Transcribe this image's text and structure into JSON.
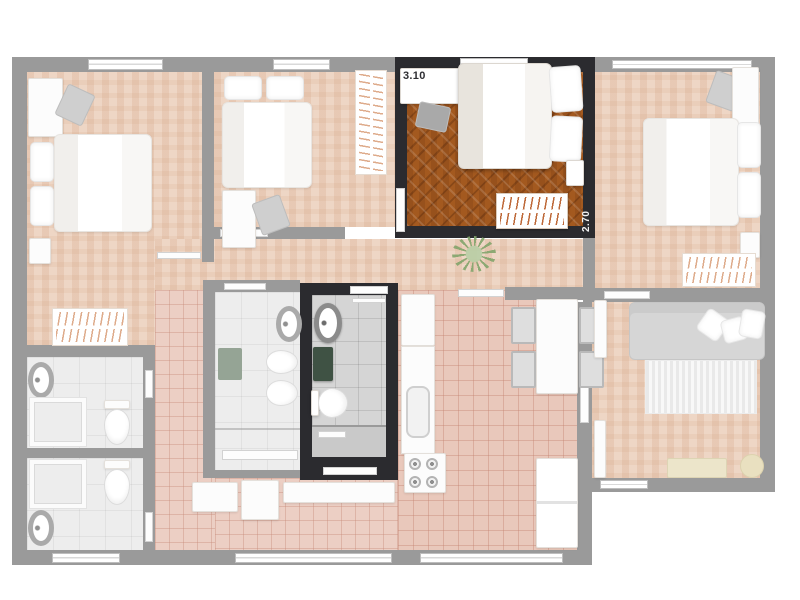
{
  "plan": {
    "type": "apartment-floor-plan",
    "highlighted_room": {
      "name": "bedroom",
      "width_label": "3.10",
      "depth_label": "2.70"
    },
    "rooms": [
      {
        "id": "bedroom-left",
        "type": "bedroom",
        "state": "dimmed"
      },
      {
        "id": "bedroom-center",
        "type": "bedroom",
        "state": "dimmed"
      },
      {
        "id": "bedroom-highlighted",
        "type": "bedroom",
        "state": "highlighted"
      },
      {
        "id": "bedroom-right",
        "type": "bedroom",
        "state": "dimmed"
      },
      {
        "id": "bathroom-left-top",
        "type": "bathroom",
        "state": "dimmed"
      },
      {
        "id": "bathroom-left-bottom",
        "type": "bathroom",
        "state": "dimmed"
      },
      {
        "id": "bathroom-center",
        "type": "bathroom",
        "state": "dimmed"
      },
      {
        "id": "bathroom-highlighted",
        "type": "bathroom",
        "state": "highlighted"
      },
      {
        "id": "kitchen",
        "type": "kitchen",
        "state": "dimmed"
      },
      {
        "id": "living-room",
        "type": "living-room",
        "state": "dimmed"
      },
      {
        "id": "laundry",
        "type": "laundry",
        "state": "dimmed"
      },
      {
        "id": "hallway",
        "type": "hallway",
        "state": "dimmed"
      }
    ],
    "furniture_icons": [
      "bed",
      "pillow",
      "desk",
      "chair",
      "wardrobe-rack",
      "nightstand",
      "round-sink",
      "toilet",
      "bidet",
      "shower",
      "bath-mat",
      "laundry-tub",
      "washing-machine",
      "counter",
      "kitchen-sink",
      "stove",
      "refrigerator",
      "dining-table",
      "dining-chair",
      "sofa",
      "rug",
      "tv-stand",
      "pouf",
      "plant",
      "door-leaf",
      "window"
    ],
    "colors": {
      "background": "#ffffff",
      "wall_dimmed": "#9a9a9a",
      "wall_highlight": "#2b2b2f",
      "parquet_highlight": "#a3591f",
      "parquet_dimmed": "#eed6c5",
      "tile_pink": "#eccfc4",
      "tile_bath_dimmed": "#ededed",
      "tile_bath_highlight": "#d5d5d5",
      "hanger_accent": "#ba602d",
      "mat_green_highlight": "#3f5244",
      "mat_green_dimmed": "#95a495"
    }
  }
}
